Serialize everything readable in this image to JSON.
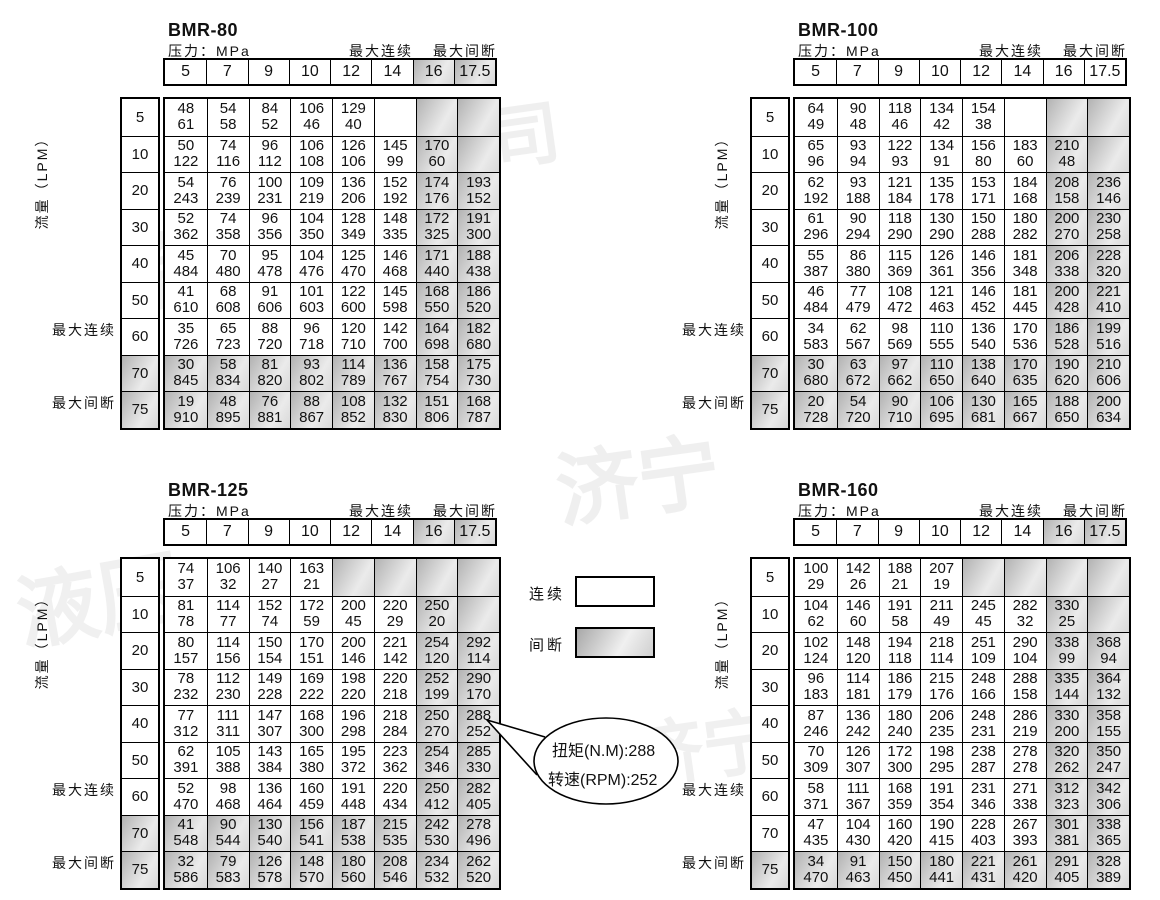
{
  "labels": {
    "pressure": "压力：MPa",
    "max_continuous": "最大连续",
    "max_intermittent": "最大间断",
    "flow": "流量（LPM）"
  },
  "legend": {
    "continuous": "连续",
    "intermittent": "间断"
  },
  "callout": {
    "line1": "扭矩(N.M):288",
    "line2": "转速(RPM):252"
  },
  "colors": {
    "shade_from": "#b2b2b2",
    "shade_to": "#ebebeb",
    "border": "#000000"
  },
  "pressures": [
    "5",
    "7",
    "9",
    "10",
    "12",
    "14",
    "16",
    "17.5"
  ],
  "flows": [
    "5",
    "10",
    "20",
    "30",
    "40",
    "50",
    "60",
    "70",
    "75"
  ],
  "tables": [
    {
      "title": "BMR-80",
      "header_shaded_cols": [
        6,
        7
      ],
      "shaded_rows": [
        7,
        8
      ],
      "rows": [
        [
          [
            "48",
            "61"
          ],
          [
            "54",
            "58"
          ],
          [
            "84",
            "52"
          ],
          [
            "106",
            "46"
          ],
          [
            "129",
            "40"
          ],
          null,
          "s",
          "s"
        ],
        [
          [
            "50",
            "122"
          ],
          [
            "74",
            "116"
          ],
          [
            "96",
            "112"
          ],
          [
            "106",
            "108"
          ],
          [
            "126",
            "106"
          ],
          [
            "145",
            "99"
          ],
          [
            "170",
            "60"
          ],
          "s"
        ],
        [
          [
            "54",
            "243"
          ],
          [
            "76",
            "239"
          ],
          [
            "100",
            "231"
          ],
          [
            "109",
            "219"
          ],
          [
            "136",
            "206"
          ],
          [
            "152",
            "192"
          ],
          [
            "174",
            "176"
          ],
          [
            "193",
            "152"
          ]
        ],
        [
          [
            "52",
            "362"
          ],
          [
            "74",
            "358"
          ],
          [
            "96",
            "356"
          ],
          [
            "104",
            "350"
          ],
          [
            "128",
            "349"
          ],
          [
            "148",
            "335"
          ],
          [
            "172",
            "325"
          ],
          [
            "191",
            "300"
          ]
        ],
        [
          [
            "45",
            "484"
          ],
          [
            "70",
            "480"
          ],
          [
            "95",
            "478"
          ],
          [
            "104",
            "476"
          ],
          [
            "125",
            "470"
          ],
          [
            "146",
            "468"
          ],
          [
            "171",
            "440"
          ],
          [
            "188",
            "438"
          ]
        ],
        [
          [
            "41",
            "610"
          ],
          [
            "68",
            "608"
          ],
          [
            "91",
            "606"
          ],
          [
            "101",
            "603"
          ],
          [
            "122",
            "600"
          ],
          [
            "145",
            "598"
          ],
          [
            "168",
            "550"
          ],
          [
            "186",
            "520"
          ]
        ],
        [
          [
            "35",
            "726"
          ],
          [
            "65",
            "723"
          ],
          [
            "88",
            "720"
          ],
          [
            "96",
            "718"
          ],
          [
            "120",
            "710"
          ],
          [
            "142",
            "700"
          ],
          [
            "164",
            "698"
          ],
          [
            "182",
            "680"
          ]
        ],
        [
          [
            "30",
            "845"
          ],
          [
            "58",
            "834"
          ],
          [
            "81",
            "820"
          ],
          [
            "93",
            "802"
          ],
          [
            "114",
            "789"
          ],
          [
            "136",
            "767"
          ],
          [
            "158",
            "754"
          ],
          [
            "175",
            "730"
          ]
        ],
        [
          [
            "19",
            "910"
          ],
          [
            "48",
            "895"
          ],
          [
            "76",
            "881"
          ],
          [
            "88",
            "867"
          ],
          [
            "108",
            "852"
          ],
          [
            "132",
            "830"
          ],
          [
            "151",
            "806"
          ],
          [
            "168",
            "787"
          ]
        ]
      ]
    },
    {
      "title": "BMR-100",
      "header_shaded_cols": [],
      "shaded_rows": [
        7,
        8
      ],
      "rows": [
        [
          [
            "64",
            "49"
          ],
          [
            "90",
            "48"
          ],
          [
            "118",
            "46"
          ],
          [
            "134",
            "42"
          ],
          [
            "154",
            "38"
          ],
          null,
          "s",
          "s"
        ],
        [
          [
            "65",
            "96"
          ],
          [
            "93",
            "94"
          ],
          [
            "122",
            "93"
          ],
          [
            "134",
            "91"
          ],
          [
            "156",
            "80"
          ],
          [
            "183",
            "60"
          ],
          [
            "210",
            "48"
          ],
          "s"
        ],
        [
          [
            "62",
            "192"
          ],
          [
            "93",
            "188"
          ],
          [
            "121",
            "184"
          ],
          [
            "135",
            "178"
          ],
          [
            "153",
            "171"
          ],
          [
            "184",
            "168"
          ],
          [
            "208",
            "158"
          ],
          [
            "236",
            "146"
          ]
        ],
        [
          [
            "61",
            "296"
          ],
          [
            "90",
            "294"
          ],
          [
            "118",
            "290"
          ],
          [
            "130",
            "290"
          ],
          [
            "150",
            "288"
          ],
          [
            "180",
            "282"
          ],
          [
            "200",
            "270"
          ],
          [
            "230",
            "258"
          ]
        ],
        [
          [
            "55",
            "387"
          ],
          [
            "86",
            "380"
          ],
          [
            "115",
            "369"
          ],
          [
            "126",
            "361"
          ],
          [
            "146",
            "356"
          ],
          [
            "181",
            "348"
          ],
          [
            "206",
            "338"
          ],
          [
            "228",
            "320"
          ]
        ],
        [
          [
            "46",
            "484"
          ],
          [
            "77",
            "479"
          ],
          [
            "108",
            "472"
          ],
          [
            "121",
            "463"
          ],
          [
            "146",
            "452"
          ],
          [
            "181",
            "445"
          ],
          [
            "200",
            "428"
          ],
          [
            "221",
            "410"
          ]
        ],
        [
          [
            "34",
            "583"
          ],
          [
            "62",
            "567"
          ],
          [
            "98",
            "569"
          ],
          [
            "110",
            "555"
          ],
          [
            "136",
            "540"
          ],
          [
            "170",
            "536"
          ],
          [
            "186",
            "528"
          ],
          [
            "199",
            "516"
          ]
        ],
        [
          [
            "30",
            "680"
          ],
          [
            "63",
            "672"
          ],
          [
            "97",
            "662"
          ],
          [
            "110",
            "650"
          ],
          [
            "138",
            "640"
          ],
          [
            "170",
            "635"
          ],
          [
            "190",
            "620"
          ],
          [
            "210",
            "606"
          ]
        ],
        [
          [
            "20",
            "728"
          ],
          [
            "54",
            "720"
          ],
          [
            "90",
            "710"
          ],
          [
            "106",
            "695"
          ],
          [
            "130",
            "681"
          ],
          [
            "165",
            "667"
          ],
          [
            "188",
            "650"
          ],
          [
            "200",
            "634"
          ]
        ]
      ]
    },
    {
      "title": "BMR-125",
      "header_shaded_cols": [
        6,
        7
      ],
      "shaded_rows": [
        7,
        8
      ],
      "rows": [
        [
          [
            "74",
            "37"
          ],
          [
            "106",
            "32"
          ],
          [
            "140",
            "27"
          ],
          [
            "163",
            "21"
          ],
          "s",
          "s",
          "s",
          "s"
        ],
        [
          [
            "81",
            "78"
          ],
          [
            "114",
            "77"
          ],
          [
            "152",
            "74"
          ],
          [
            "172",
            "59"
          ],
          [
            "200",
            "45"
          ],
          [
            "220",
            "29"
          ],
          [
            "250",
            "20"
          ],
          "s"
        ],
        [
          [
            "80",
            "157"
          ],
          [
            "114",
            "156"
          ],
          [
            "150",
            "154"
          ],
          [
            "170",
            "151"
          ],
          [
            "200",
            "146"
          ],
          [
            "221",
            "142"
          ],
          [
            "254",
            "120"
          ],
          [
            "292",
            "114"
          ]
        ],
        [
          [
            "78",
            "232"
          ],
          [
            "112",
            "230"
          ],
          [
            "149",
            "228"
          ],
          [
            "169",
            "222"
          ],
          [
            "198",
            "220"
          ],
          [
            "220",
            "218"
          ],
          [
            "252",
            "199"
          ],
          [
            "290",
            "170"
          ]
        ],
        [
          [
            "77",
            "312"
          ],
          [
            "111",
            "311"
          ],
          [
            "147",
            "307"
          ],
          [
            "168",
            "300"
          ],
          [
            "196",
            "298"
          ],
          [
            "218",
            "284"
          ],
          [
            "250",
            "270"
          ],
          [
            "288",
            "252"
          ]
        ],
        [
          [
            "62",
            "391"
          ],
          [
            "105",
            "388"
          ],
          [
            "143",
            "384"
          ],
          [
            "165",
            "380"
          ],
          [
            "195",
            "372"
          ],
          [
            "223",
            "362"
          ],
          [
            "254",
            "346"
          ],
          [
            "285",
            "330"
          ]
        ],
        [
          [
            "52",
            "470"
          ],
          [
            "98",
            "468"
          ],
          [
            "136",
            "464"
          ],
          [
            "160",
            "459"
          ],
          [
            "191",
            "448"
          ],
          [
            "220",
            "434"
          ],
          [
            "250",
            "412"
          ],
          [
            "282",
            "405"
          ]
        ],
        [
          [
            "41",
            "548"
          ],
          [
            "90",
            "544"
          ],
          [
            "130",
            "540"
          ],
          [
            "156",
            "541"
          ],
          [
            "187",
            "538"
          ],
          [
            "215",
            "535"
          ],
          [
            "242",
            "530"
          ],
          [
            "278",
            "496"
          ]
        ],
        [
          [
            "32",
            "586"
          ],
          [
            "79",
            "583"
          ],
          [
            "126",
            "578"
          ],
          [
            "148",
            "570"
          ],
          [
            "180",
            "560"
          ],
          [
            "208",
            "546"
          ],
          [
            "234",
            "532"
          ],
          [
            "262",
            "520"
          ]
        ]
      ]
    },
    {
      "title": "BMR-160",
      "header_shaded_cols": [
        6,
        7
      ],
      "shaded_rows": [
        8
      ],
      "rows": [
        [
          [
            "100",
            "29"
          ],
          [
            "142",
            "26"
          ],
          [
            "188",
            "21"
          ],
          [
            "207",
            "19"
          ],
          "s",
          "s",
          "s",
          "s"
        ],
        [
          [
            "104",
            "62"
          ],
          [
            "146",
            "60"
          ],
          [
            "191",
            "58"
          ],
          [
            "211",
            "49"
          ],
          [
            "245",
            "45"
          ],
          [
            "282",
            "32"
          ],
          [
            "330",
            "25"
          ],
          "s"
        ],
        [
          [
            "102",
            "124"
          ],
          [
            "148",
            "120"
          ],
          [
            "194",
            "118"
          ],
          [
            "218",
            "114"
          ],
          [
            "251",
            "109"
          ],
          [
            "290",
            "104"
          ],
          [
            "338",
            "99"
          ],
          [
            "368",
            "94"
          ]
        ],
        [
          [
            "96",
            "183"
          ],
          [
            "114",
            "181"
          ],
          [
            "186",
            "179"
          ],
          [
            "215",
            "176"
          ],
          [
            "248",
            "166"
          ],
          [
            "288",
            "158"
          ],
          [
            "335",
            "144"
          ],
          [
            "364",
            "132"
          ]
        ],
        [
          [
            "87",
            "246"
          ],
          [
            "136",
            "242"
          ],
          [
            "180",
            "240"
          ],
          [
            "206",
            "235"
          ],
          [
            "248",
            "231"
          ],
          [
            "286",
            "219"
          ],
          [
            "330",
            "200"
          ],
          [
            "358",
            "155"
          ]
        ],
        [
          [
            "70",
            "309"
          ],
          [
            "126",
            "307"
          ],
          [
            "172",
            "300"
          ],
          [
            "198",
            "295"
          ],
          [
            "238",
            "287"
          ],
          [
            "278",
            "278"
          ],
          [
            "320",
            "262"
          ],
          [
            "350",
            "247"
          ]
        ],
        [
          [
            "58",
            "371"
          ],
          [
            "111",
            "367"
          ],
          [
            "168",
            "359"
          ],
          [
            "191",
            "354"
          ],
          [
            "231",
            "346"
          ],
          [
            "271",
            "338"
          ],
          [
            "312",
            "323"
          ],
          [
            "342",
            "306"
          ]
        ],
        [
          [
            "47",
            "435"
          ],
          [
            "104",
            "430"
          ],
          [
            "160",
            "420"
          ],
          [
            "190",
            "415"
          ],
          [
            "228",
            "403"
          ],
          [
            "267",
            "393"
          ],
          [
            "301",
            "381"
          ],
          [
            "338",
            "365"
          ]
        ],
        [
          [
            "34",
            "470"
          ],
          [
            "91",
            "463"
          ],
          [
            "150",
            "450"
          ],
          [
            "180",
            "441"
          ],
          [
            "221",
            "431"
          ],
          [
            "261",
            "420"
          ],
          [
            "291",
            "405"
          ],
          [
            "328",
            "389"
          ]
        ]
      ]
    }
  ],
  "watermarks": [
    {
      "text": "限公司",
      "x": 350,
      "y": 90,
      "size": 70,
      "rot": -8,
      "op": 0.06
    },
    {
      "text": "有限",
      "x": 130,
      "y": 195,
      "size": 82,
      "rot": -12,
      "op": 0.055
    },
    {
      "text": "济宁",
      "x": 555,
      "y": 415,
      "size": 82,
      "rot": -8,
      "op": 0.06
    },
    {
      "text": "液压",
      "x": 15,
      "y": 535,
      "size": 82,
      "rot": -10,
      "op": 0.055
    },
    {
      "text": "有限公司",
      "x": 870,
      "y": 555,
      "size": 66,
      "rot": -10,
      "op": 0.05
    },
    {
      "text": "济宁",
      "x": 630,
      "y": 690,
      "size": 72,
      "rot": -8,
      "op": 0.055
    }
  ]
}
